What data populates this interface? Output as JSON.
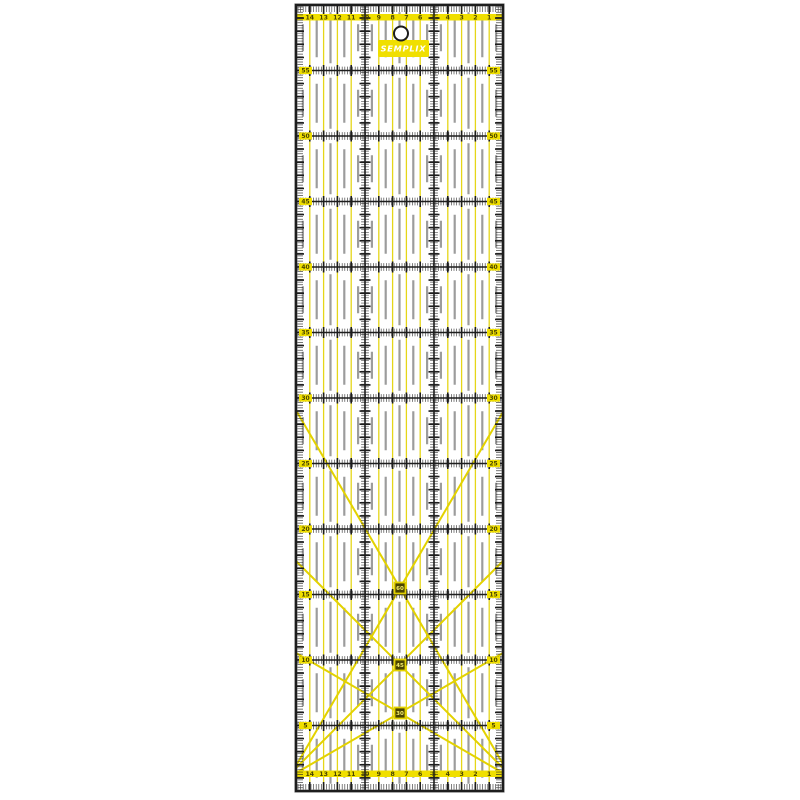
{
  "colors": {
    "background": "#ffffff",
    "accent_yellow": "#f0df00",
    "line_yellow": "#e3d200",
    "grid_black": "#1d1d1d",
    "dash_gray": "#9c9c9c",
    "scale_digit": "#4a4500",
    "logo_text": "#ffffff",
    "marker_fill": "#4a4400",
    "marker_text": "#f7ef6a"
  },
  "ruler": {
    "brand": "SEMPLIX",
    "top_scale": {
      "numbers": [
        "14",
        "13",
        "12",
        "11",
        "10",
        "9",
        "8",
        "7",
        "6",
        "5",
        "4",
        "3",
        "2",
        "1"
      ]
    },
    "bottom_scale": {
      "numbers": [
        "14",
        "13",
        "12",
        "11",
        "10",
        "9",
        "8",
        "7",
        "6",
        "5",
        "4",
        "3",
        "2",
        "1"
      ]
    },
    "left_row_labels": [
      "55",
      "50",
      "45",
      "40",
      "35",
      "30",
      "25",
      "20",
      "15",
      "10",
      "5"
    ],
    "right_row_labels": [
      "55",
      "50",
      "45",
      "40",
      "35",
      "30",
      "25",
      "20",
      "15",
      "10",
      "5"
    ],
    "angle_markers": [
      "60",
      "45",
      "30"
    ]
  }
}
